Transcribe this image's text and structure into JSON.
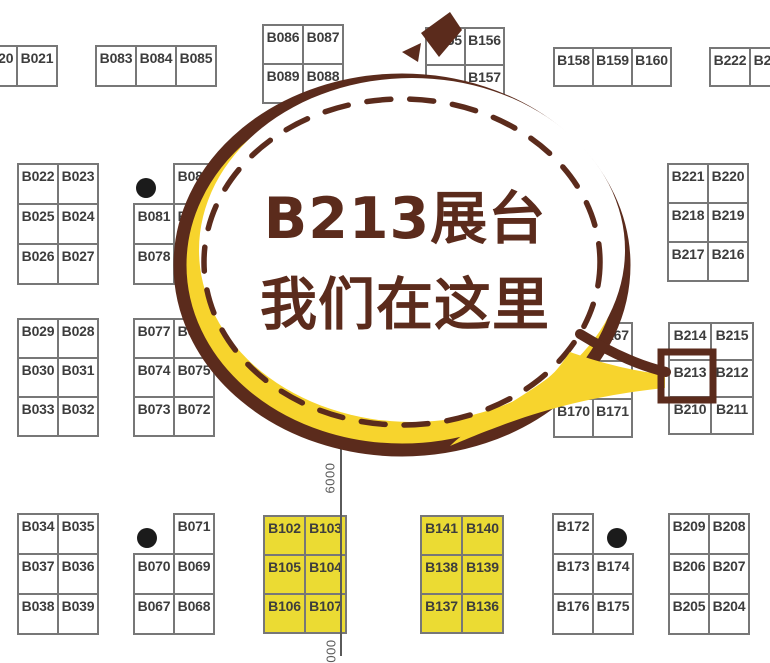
{
  "callout": {
    "line1": "B213展台",
    "line2": "我们在这里",
    "target_booth": "B213"
  },
  "colors": {
    "brown": "#5B2B1C",
    "yellow": "#F7D42D",
    "boothyellow": "#EBDB33",
    "border": "#777777",
    "text": "#3D3D3D",
    "black": "#1B1B1B",
    "line": "#5A5A5A"
  },
  "dimension_labels": [
    {
      "text": "6000"
    },
    {
      "text": "000"
    }
  ],
  "booth_groups": [
    {
      "x": -24,
      "y": 45,
      "cw": 40,
      "ch": 40,
      "fill": "white",
      "cells": [
        [
          "B020",
          "B021"
        ]
      ]
    },
    {
      "x": 95,
      "y": 45,
      "cw": 40,
      "ch": 40,
      "fill": "white",
      "cells": [
        [
          "B083",
          "B084",
          "B085"
        ]
      ]
    },
    {
      "x": 262,
      "y": 24,
      "cw": 40,
      "ch": 39,
      "fill": "white",
      "cells": [
        [
          "B086",
          "B087"
        ],
        [
          "B089",
          "B088"
        ]
      ]
    },
    {
      "x": 425,
      "y": 27,
      "cw": 39,
      "ch": 37,
      "fill": "white",
      "cells": [
        [
          "B155",
          "B156"
        ],
        [
          "",
          "B157"
        ]
      ]
    },
    {
      "x": 553,
      "y": 47,
      "cw": 39,
      "ch": 38,
      "fill": "white",
      "cells": [
        [
          "B158",
          "B159",
          "B160"
        ]
      ]
    },
    {
      "x": 709,
      "y": 47,
      "cw": 40,
      "ch": 38,
      "fill": "white",
      "cells": [
        [
          "B222",
          "B223"
        ]
      ]
    },
    {
      "x": 17,
      "y": 163,
      "cw": 40,
      "ch": 40,
      "fill": "white",
      "cells": [
        [
          "B022",
          "B023"
        ],
        [
          "B025",
          "B024"
        ],
        [
          "B026",
          "B027"
        ]
      ]
    },
    {
      "x": 133,
      "y": 163,
      "cw": 40,
      "ch": 40,
      "fill": "white",
      "cells": [
        [
          null,
          "B082"
        ],
        [
          "B081",
          "B080"
        ],
        [
          "B078",
          ""
        ]
      ]
    },
    {
      "x": 17,
      "y": 318,
      "cw": 40,
      "ch": 39,
      "fill": "white",
      "cells": [
        [
          "B029",
          "B028"
        ],
        [
          "B030",
          "B031"
        ],
        [
          "B033",
          "B032"
        ]
      ]
    },
    {
      "x": 133,
      "y": 318,
      "cw": 40,
      "ch": 39,
      "fill": "white",
      "cells": [
        [
          "B077",
          "B076"
        ],
        [
          "B074",
          "B075"
        ],
        [
          "B073",
          "B072"
        ]
      ]
    },
    {
      "x": 17,
      "y": 513,
      "cw": 40,
      "ch": 40,
      "fill": "white",
      "cells": [
        [
          "B034",
          "B035"
        ],
        [
          "B037",
          "B036"
        ],
        [
          "B038",
          "B039"
        ]
      ]
    },
    {
      "x": 133,
      "y": 513,
      "cw": 40,
      "ch": 40,
      "fill": "white",
      "cells": [
        [
          null,
          "B071"
        ],
        [
          "B070",
          "B069"
        ],
        [
          "B067",
          "B068"
        ]
      ]
    },
    {
      "x": 263,
      "y": 515,
      "cw": 41,
      "ch": 39,
      "fill": "yellow",
      "cells": [
        [
          "B102",
          "B103"
        ],
        [
          "B105",
          "B104"
        ],
        [
          "B106",
          "B107"
        ]
      ]
    },
    {
      "x": 420,
      "y": 515,
      "cw": 41,
      "ch": 39,
      "fill": "yellow",
      "cells": [
        [
          "B141",
          "B140"
        ],
        [
          "B138",
          "B139"
        ],
        [
          "B137",
          "B136"
        ]
      ]
    },
    {
      "x": 552,
      "y": 513,
      "cw": 40,
      "ch": 40,
      "fill": "white",
      "cells": [
        [
          "B172",
          null
        ],
        [
          "B173",
          "B174"
        ],
        [
          "B176",
          "B175"
        ]
      ]
    },
    {
      "x": 668,
      "y": 513,
      "cw": 40,
      "ch": 40,
      "fill": "white",
      "cells": [
        [
          "B209",
          "B208"
        ],
        [
          "B206",
          "B207"
        ],
        [
          "B205",
          "B204"
        ]
      ]
    },
    {
      "x": 667,
      "y": 163,
      "cw": 40,
      "ch": 39,
      "fill": "white",
      "cells": [
        [
          "B221",
          "B220"
        ],
        [
          "B218",
          "B219"
        ],
        [
          "B217",
          "B216"
        ]
      ]
    },
    {
      "x": 668,
      "y": 322,
      "cw": 42,
      "ch": 37,
      "fill": "white",
      "cells": [
        [
          "B214",
          "B215"
        ],
        [
          "B213",
          "B212"
        ],
        [
          "B210",
          "B211"
        ]
      ]
    },
    {
      "x": 553,
      "y": 322,
      "cw": 39,
      "ch": 38,
      "fill": "white",
      "cells": [
        [
          "",
          "B167"
        ],
        [
          "",
          ""
        ],
        [
          "B170",
          "B171"
        ]
      ]
    }
  ],
  "dots": [
    {
      "x": 146,
      "y": 188,
      "r": 10
    },
    {
      "x": 147,
      "y": 538,
      "r": 10
    },
    {
      "x": 617,
      "y": 538,
      "r": 10
    }
  ]
}
